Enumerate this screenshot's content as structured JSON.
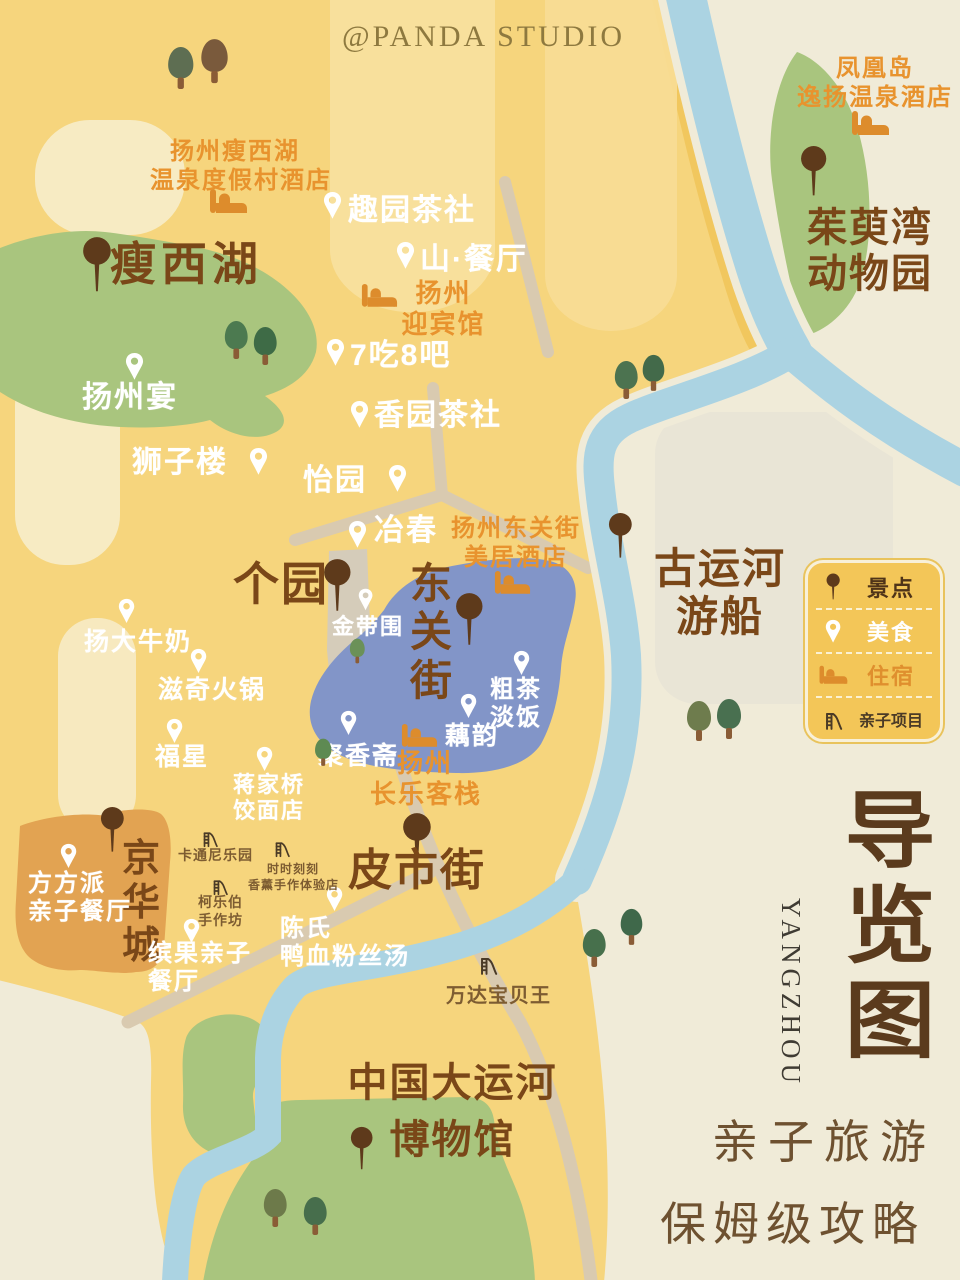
{
  "watermark": "@PANDA STUDIO",
  "panel": {
    "title_chars": [
      "导",
      "览",
      "图"
    ],
    "subtitle_en": "YANGZHOU",
    "tagline_line1": "亲子旅游",
    "tagline_line2": "保姆级攻略"
  },
  "legend": {
    "items": [
      {
        "icon": "attraction-pin-icon",
        "label": "景点"
      },
      {
        "icon": "food-pin-icon",
        "label": "美食"
      },
      {
        "icon": "hotel-bed-icon",
        "label": "住宿"
      },
      {
        "icon": "kids-slide-icon",
        "label": "亲子项目"
      }
    ]
  },
  "colors": {
    "bg_cream": "#f0ebd8",
    "map_yellow": "#f6d57d",
    "river_blue": "#abd3e2",
    "lake_green": "#a9c57e",
    "district_blue": "#8295c8",
    "block_orange": "#e2a352",
    "sight_pin": "#5e3a1b",
    "food_pin": "#ffffff",
    "hotel_icon": "#dd8c2c",
    "kids_icon": "#4a3a26",
    "sight_text": "#7a4718",
    "hotel_text": "#e8932e",
    "title_brown": "#5b3b1d"
  },
  "pois": [
    {
      "id": "shouxihu",
      "type": "sight",
      "lines": [
        "瘦西湖"
      ],
      "pin": {
        "x": 82,
        "y": 236,
        "s": 1.15
      },
      "text": {
        "x": 110,
        "y": 238,
        "size": 46,
        "ls": 5
      }
    },
    {
      "id": "geyuan",
      "type": "sight",
      "lines": [
        "个园"
      ],
      "pin": {
        "x": 323,
        "y": 558,
        "s": 1.1
      },
      "text": {
        "x": 233,
        "y": 558,
        "size": 46
      }
    },
    {
      "id": "dongguan-street",
      "type": "sight",
      "lines": [
        "东",
        "关",
        "街"
      ],
      "pin": {
        "x": 455,
        "y": 592,
        "s": 1.1
      },
      "text": {
        "x": 410,
        "y": 560,
        "size": 42
      }
    },
    {
      "id": "pishi-street",
      "type": "sight",
      "lines": [
        "皮市街"
      ],
      "pin": {
        "x": 402,
        "y": 812,
        "s": 1.15
      },
      "text": {
        "x": 348,
        "y": 846,
        "size": 44
      }
    },
    {
      "id": "jinghuacheng",
      "type": "sight",
      "lines": [
        "京",
        "华",
        "城"
      ],
      "pin": {
        "x": 100,
        "y": 806,
        "s": 0.95
      },
      "text": {
        "x": 122,
        "y": 838,
        "size": 38
      }
    },
    {
      "id": "zhuyuwan-zoo",
      "type": "sight",
      "lines": [
        "茱萸湾",
        "动物园"
      ],
      "pin": {
        "x": 800,
        "y": 145,
        "s": 1.05
      },
      "text": {
        "x": 790,
        "y": 205,
        "size": 40,
        "w": 160,
        "align": "center"
      }
    },
    {
      "id": "guyunhe-cruise",
      "type": "sight",
      "lines": [
        "古运河",
        "游船"
      ],
      "pin": {
        "x": 608,
        "y": 512,
        "s": 0.95
      },
      "text": {
        "x": 645,
        "y": 545,
        "size": 42,
        "w": 150,
        "align": "center"
      }
    },
    {
      "id": "canal-museum",
      "type": "sight",
      "lines": [
        "中国大运河",
        "博物馆"
      ],
      "pin": {
        "x": 350,
        "y": 1126,
        "s": 0.9
      },
      "text": {
        "x": 325,
        "y": 1055,
        "size": 40,
        "w": 255,
        "align": "center",
        "lh": 1.42
      }
    },
    {
      "id": "quyuan-teahouse",
      "type": "food",
      "lines": [
        "趣园茶社"
      ],
      "pin": {
        "x": 323,
        "y": 191,
        "s": 1
      },
      "text": {
        "x": 348,
        "y": 193,
        "size": 30
      }
    },
    {
      "id": "shan-restaurant",
      "type": "food",
      "lines": [
        "山·餐厅"
      ],
      "pin": {
        "x": 396,
        "y": 241,
        "s": 1
      },
      "text": {
        "x": 420,
        "y": 242,
        "size": 30
      }
    },
    {
      "id": "7chi8ba",
      "type": "food",
      "lines": [
        "7吃8吧"
      ],
      "pin": {
        "x": 326,
        "y": 338,
        "s": 1
      },
      "text": {
        "x": 350,
        "y": 338,
        "size": 30
      }
    },
    {
      "id": "yangzhou-yan",
      "type": "food",
      "lines": [
        "扬州宴"
      ],
      "pin": {
        "x": 125,
        "y": 352,
        "s": 1
      },
      "text": {
        "x": 82,
        "y": 380,
        "size": 30
      }
    },
    {
      "id": "xiangyuan-teahouse",
      "type": "food",
      "lines": [
        "香园茶社"
      ],
      "pin": {
        "x": 350,
        "y": 400,
        "s": 1
      },
      "text": {
        "x": 374,
        "y": 398,
        "size": 30
      }
    },
    {
      "id": "shizilou",
      "type": "food",
      "lines": [
        "狮子楼"
      ],
      "pin": {
        "x": 249,
        "y": 447,
        "s": 1
      },
      "text": {
        "x": 132,
        "y": 445,
        "size": 30
      }
    },
    {
      "id": "yiyuan",
      "type": "food",
      "lines": [
        "怡园"
      ],
      "pin": {
        "x": 388,
        "y": 464,
        "s": 1
      },
      "text": {
        "x": 303,
        "y": 463,
        "size": 30
      }
    },
    {
      "id": "yechun",
      "type": "food",
      "lines": [
        "冶春"
      ],
      "pin": {
        "x": 348,
        "y": 520,
        "s": 1
      },
      "text": {
        "x": 374,
        "y": 513,
        "size": 30
      }
    },
    {
      "id": "jindaiwei",
      "type": "food",
      "lines": [
        "金带围"
      ],
      "pin": {
        "x": 358,
        "y": 588,
        "s": 0.8
      },
      "text": {
        "x": 332,
        "y": 614,
        "size": 22
      }
    },
    {
      "id": "yangda-milk",
      "type": "food",
      "lines": [
        "扬大牛奶"
      ],
      "pin": {
        "x": 118,
        "y": 598,
        "s": 0.9
      },
      "text": {
        "x": 84,
        "y": 628,
        "size": 25
      }
    },
    {
      "id": "ziqi-hotpot",
      "type": "food",
      "lines": [
        "滋奇火锅"
      ],
      "pin": {
        "x": 190,
        "y": 648,
        "s": 0.9
      },
      "text": {
        "x": 158,
        "y": 676,
        "size": 25
      }
    },
    {
      "id": "fuxing",
      "type": "food",
      "lines": [
        "福星"
      ],
      "pin": {
        "x": 166,
        "y": 718,
        "s": 0.9
      },
      "text": {
        "x": 155,
        "y": 743,
        "size": 25
      }
    },
    {
      "id": "jiangjiaqiao-noodles",
      "type": "food",
      "lines": [
        "蒋家桥",
        "饺面店"
      ],
      "pin": {
        "x": 256,
        "y": 746,
        "s": 0.9
      },
      "text": {
        "x": 233,
        "y": 772,
        "size": 22
      }
    },
    {
      "id": "juxiangzhai",
      "type": "food",
      "lines": [
        "聚香斋"
      ],
      "pin": {
        "x": 340,
        "y": 710,
        "s": 0.9
      },
      "text": {
        "x": 318,
        "y": 742,
        "size": 25
      }
    },
    {
      "id": "cucha-danfan",
      "type": "food",
      "lines": [
        "粗茶",
        "淡饭"
      ],
      "pin": {
        "x": 513,
        "y": 650,
        "s": 0.9
      },
      "text": {
        "x": 490,
        "y": 676,
        "size": 24
      }
    },
    {
      "id": "ouyun",
      "type": "food",
      "lines": [
        "藕韵"
      ],
      "pin": {
        "x": 460,
        "y": 693,
        "s": 0.9
      },
      "text": {
        "x": 445,
        "y": 722,
        "size": 25
      }
    },
    {
      "id": "fangfangpai",
      "type": "food",
      "lines": [
        "方方派",
        "亲子餐厅"
      ],
      "pin": {
        "x": 60,
        "y": 843,
        "s": 0.9
      },
      "text": {
        "x": 28,
        "y": 870,
        "size": 24
      }
    },
    {
      "id": "binguo-restaurant",
      "type": "food",
      "lines": [
        "缤果亲子",
        "餐厅"
      ],
      "pin": {
        "x": 183,
        "y": 918,
        "s": 0.9
      },
      "text": {
        "x": 148,
        "y": 940,
        "size": 24
      }
    },
    {
      "id": "chenshi-duck-soup",
      "type": "food",
      "lines": [
        "陈氏",
        "鸭血粉丝汤"
      ],
      "pin": {
        "x": 326,
        "y": 886,
        "s": 0.9
      },
      "text": {
        "x": 280,
        "y": 915,
        "size": 24
      }
    },
    {
      "id": "shouxihu-resort-hotel",
      "type": "hotel",
      "lines": [
        "扬州瘦西湖",
        "温泉度假村酒店"
      ],
      "pin": {
        "x": 208,
        "y": 188,
        "s": 1
      },
      "text": {
        "x": 150,
        "y": 138,
        "size": 24,
        "w": 170,
        "align": "center"
      }
    },
    {
      "id": "fenghuangdao-hotel",
      "type": "hotel",
      "lines": [
        "凤凰岛",
        "逸扬温泉酒店"
      ],
      "pin": {
        "x": 850,
        "y": 110,
        "s": 1
      },
      "text": {
        "x": 790,
        "y": 55,
        "size": 24,
        "w": 170,
        "align": "center"
      }
    },
    {
      "id": "yingbinguan-hotel",
      "type": "hotel",
      "lines": [
        "扬州",
        "迎宾馆"
      ],
      "pin": {
        "x": 360,
        "y": 283,
        "s": 0.95
      },
      "text": {
        "x": 396,
        "y": 278,
        "size": 26,
        "w": 95,
        "align": "center"
      }
    },
    {
      "id": "meiju-hotel",
      "type": "hotel",
      "lines": [
        "扬州东关街",
        "美居酒店"
      ],
      "pin": {
        "x": 493,
        "y": 570,
        "s": 0.95
      },
      "text": {
        "x": 446,
        "y": 515,
        "size": 24,
        "w": 140,
        "align": "center"
      }
    },
    {
      "id": "changle-inn",
      "type": "hotel",
      "lines": [
        "扬州",
        "长乐客栈"
      ],
      "pin": {
        "x": 400,
        "y": 723,
        "s": 0.95
      },
      "text": {
        "x": 370,
        "y": 748,
        "size": 26,
        "w": 110,
        "align": "center"
      }
    },
    {
      "id": "katongni-park",
      "type": "kids",
      "lines": [
        "卡通尼乐园"
      ],
      "pin": {
        "x": 201,
        "y": 828,
        "s": 0.7
      },
      "text": {
        "x": 178,
        "y": 846,
        "size": 14
      }
    },
    {
      "id": "shishikeke-workshop",
      "type": "kids",
      "lines": [
        "时时刻刻",
        "香薰手作体验店"
      ],
      "pin": {
        "x": 273,
        "y": 838,
        "s": 0.7
      },
      "text": {
        "x": 248,
        "y": 862,
        "size": 12,
        "w": 90,
        "align": "center"
      }
    },
    {
      "id": "kelebo-workshop",
      "type": "kids",
      "lines": [
        "柯乐伯",
        "手作坊"
      ],
      "pin": {
        "x": 211,
        "y": 876,
        "s": 0.7
      },
      "text": {
        "x": 198,
        "y": 893,
        "size": 14
      }
    },
    {
      "id": "wanda-kids-king",
      "type": "kids",
      "lines": [
        "万达宝贝王"
      ],
      "pin": {
        "x": 478,
        "y": 953,
        "s": 0.8
      },
      "text": {
        "x": 446,
        "y": 983,
        "size": 20
      }
    }
  ],
  "trees": [
    {
      "x": 165,
      "y": 46,
      "s": 1.05,
      "c": "#5e6e52"
    },
    {
      "x": 198,
      "y": 38,
      "s": 1.1,
      "c": "#7a5a3c"
    },
    {
      "x": 222,
      "y": 320,
      "s": 0.95,
      "c": "#4c7a50"
    },
    {
      "x": 251,
      "y": 326,
      "s": 0.95,
      "c": "#3e6b46"
    },
    {
      "x": 612,
      "y": 360,
      "s": 0.95,
      "c": "#4c7350"
    },
    {
      "x": 640,
      "y": 354,
      "s": 0.9,
      "c": "#436a4a"
    },
    {
      "x": 684,
      "y": 700,
      "s": 1.0,
      "c": "#6e7c4d"
    },
    {
      "x": 714,
      "y": 698,
      "s": 1.0,
      "c": "#497050"
    },
    {
      "x": 348,
      "y": 638,
      "s": 0.62,
      "c": "#6b9158"
    },
    {
      "x": 313,
      "y": 738,
      "s": 0.68,
      "c": "#5e8a52"
    },
    {
      "x": 580,
      "y": 928,
      "s": 0.95,
      "c": "#47704c"
    },
    {
      "x": 618,
      "y": 908,
      "s": 0.9,
      "c": "#3f684a"
    },
    {
      "x": 261,
      "y": 1188,
      "s": 0.95,
      "c": "#6d7a4a"
    },
    {
      "x": 301,
      "y": 1196,
      "s": 0.95,
      "c": "#476e4c"
    }
  ]
}
